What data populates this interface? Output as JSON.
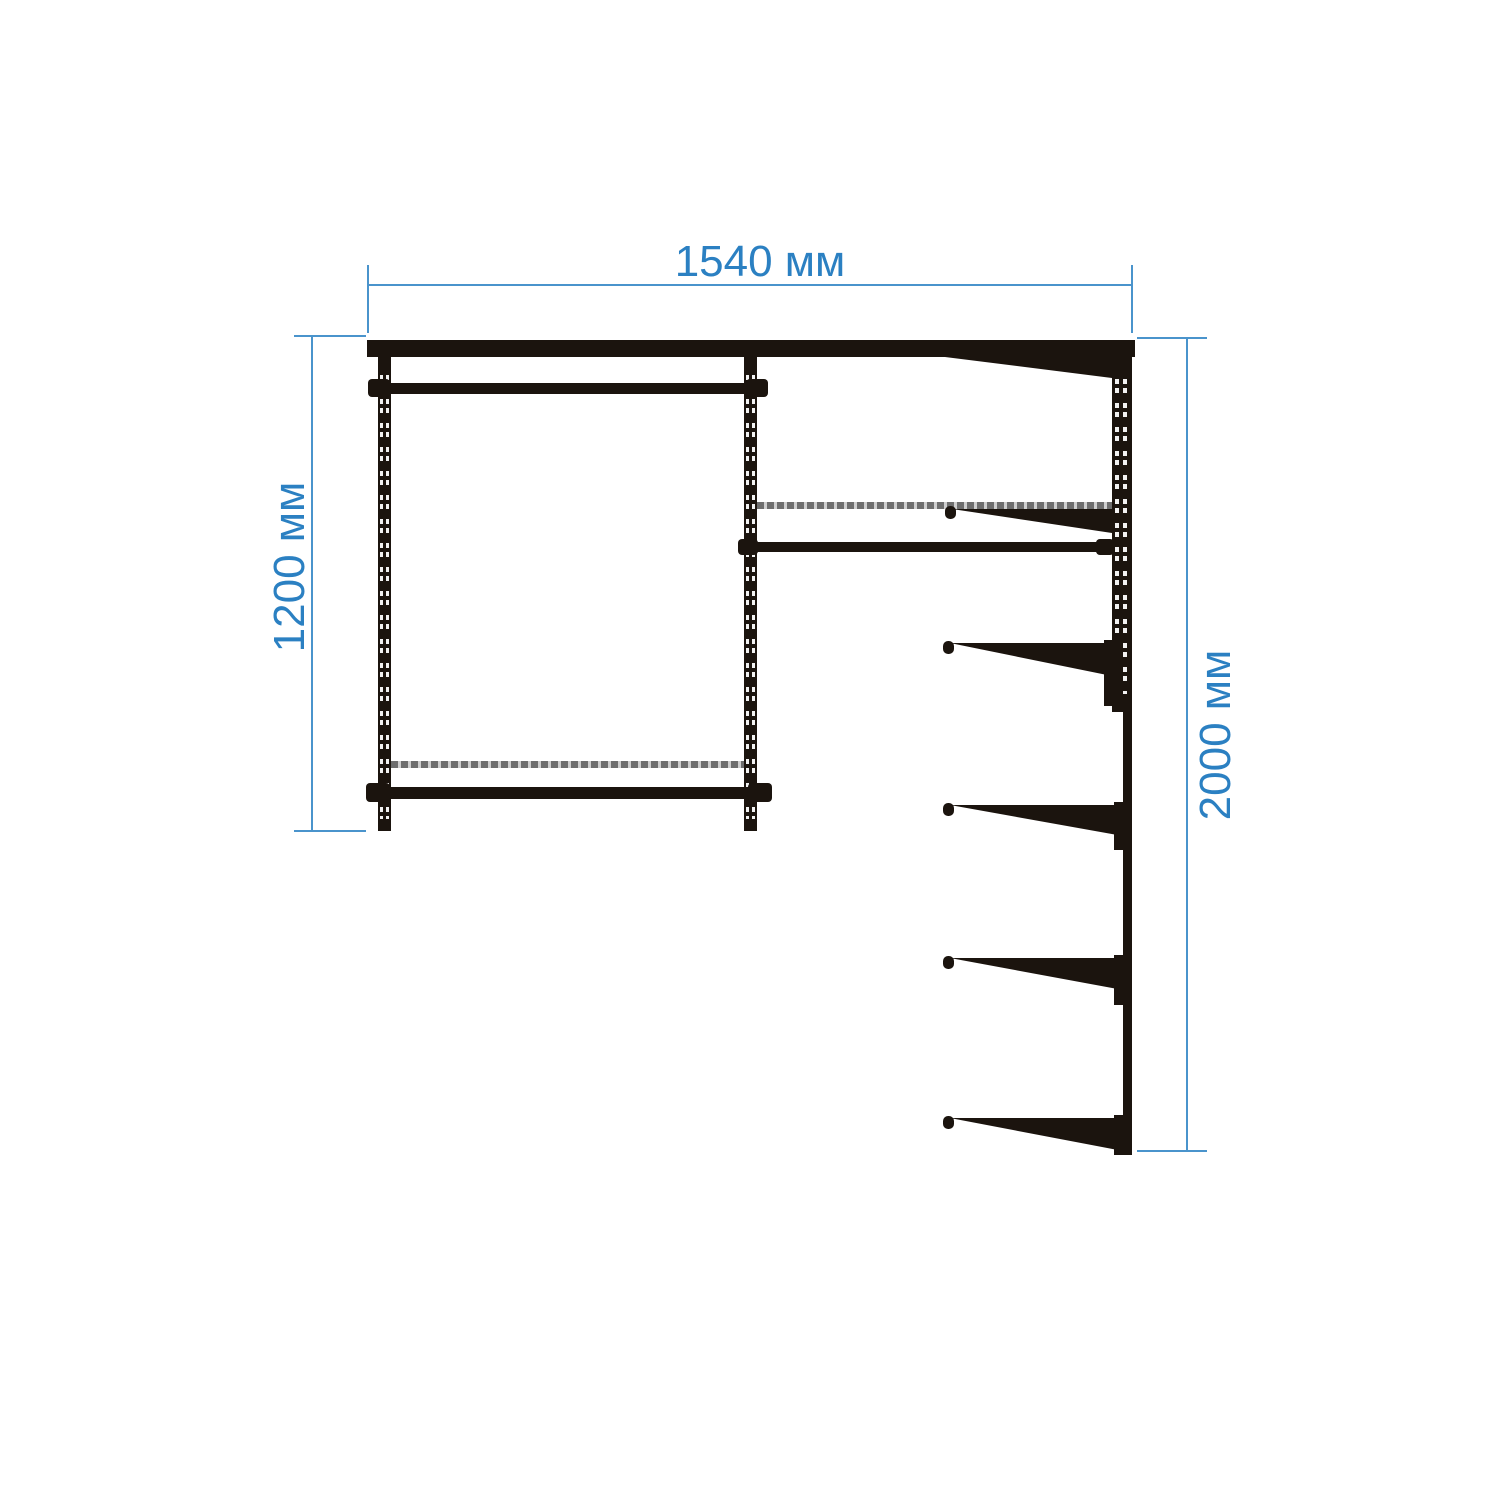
{
  "colors": {
    "background": "#ffffff",
    "structure": "#1b140e",
    "dimension_line": "#4a94cc",
    "dimension_text": "#2b80c2",
    "wire_shelf": "#8d8d8d"
  },
  "dimensions": {
    "top_width": {
      "label": "1540 мм"
    },
    "left_height": {
      "label": "1200 мм"
    },
    "right_height": {
      "label": "2000 мм"
    }
  }
}
